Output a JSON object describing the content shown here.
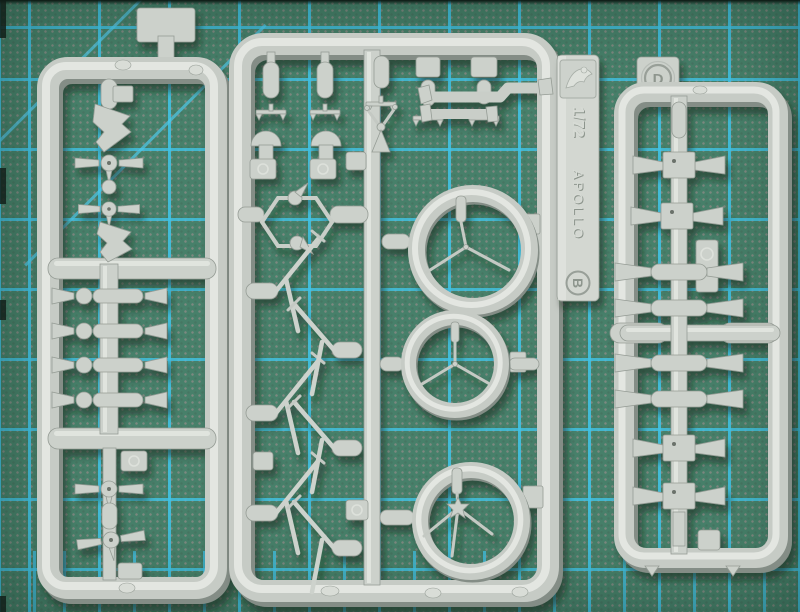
{
  "scene": {
    "subject": "three light-grey injection-moulded model kit sprues lying on a green self-healing cutting mat with cyan grid lines",
    "sprue_count": 3
  },
  "markings": {
    "center_tag": {
      "scale": "1/72",
      "brand": "APOLLO",
      "sprue_letter": "B",
      "logo": "embossed-knight-logo"
    },
    "right_sprue": {
      "sprue_letter": "D"
    }
  },
  "palette": {
    "mat_green": "#47806A",
    "grid_cyan": "#41C3E6",
    "plastic_light": "#E3E6E1",
    "plastic_base": "#C6CBC5",
    "plastic_shadow": "#848D86"
  },
  "parts_depicted": {
    "left_sprue": [
      "top hanger tab",
      "stepped wedge fairing x2",
      "three-blade propeller x4",
      "ball joint",
      "thruster row x4 (bell nozzle, disc, cylinder, cone nozzle)"
    ],
    "center_sprue": [
      "bullet fairing x3",
      "plate with pill x2",
      "T-gate x5",
      "dome with base x2",
      "whip antenna on cone",
      "angled pipe run x2",
      "hexagonal frame with two ball fittings",
      "thin V landing strut x6",
      "spoked ring large",
      "spoked ring medium",
      "spoked ring with star hub",
      "letter plates"
    ],
    "right_sprue": [
      "letter tab",
      "pill",
      "sensor block with twin cones x4",
      "double-bell nozzle bar x4",
      "cross rail with capsule ends",
      "letter plate x2"
    ]
  }
}
